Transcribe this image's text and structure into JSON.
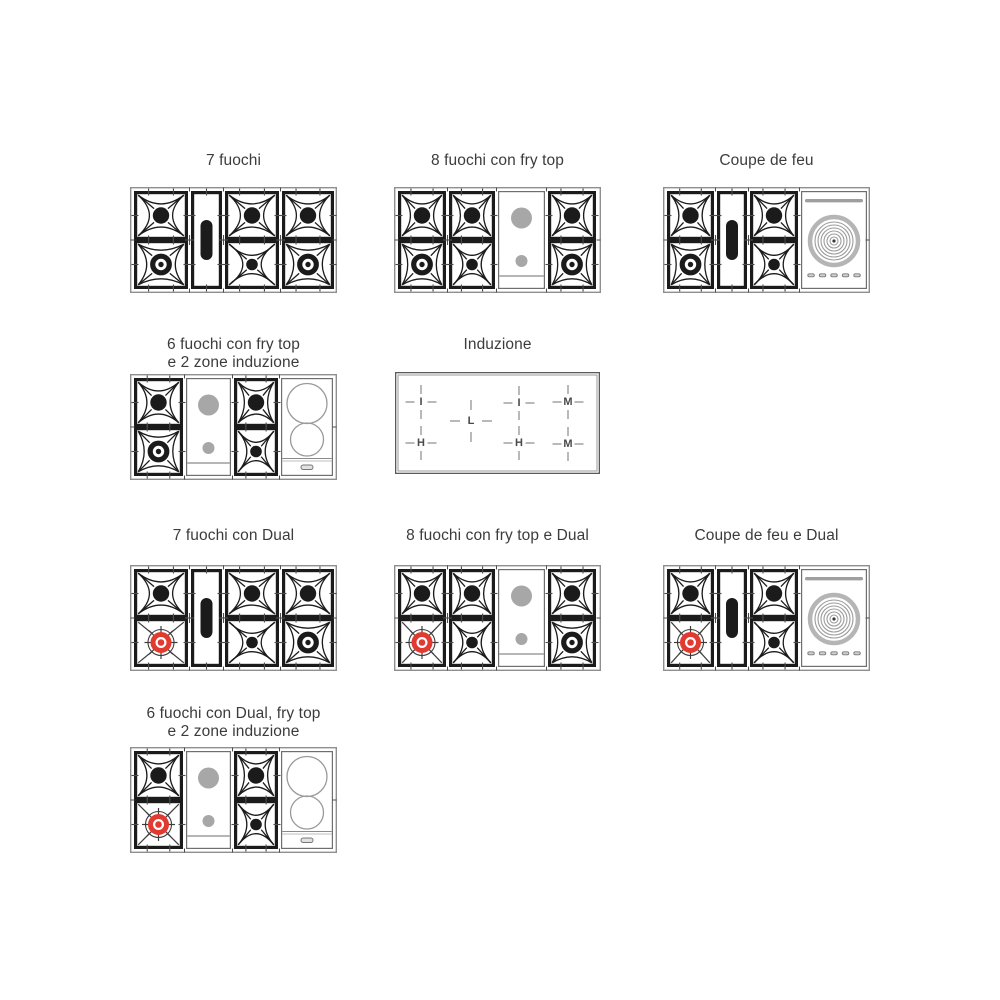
{
  "page": {
    "background": "#ffffff"
  },
  "colors": {
    "burner_black": "#1b1b1b",
    "dual_red": "#e03a31",
    "frytop_gray": "#a7a7a7",
    "panel_border": "#6f6f6f",
    "frame_gray": "#8f8f8f",
    "tick_gray": "#4d4d4d",
    "ring_light_gray": "#b5b5b5",
    "ring_mid_gray": "#9c9c9c",
    "title_text": "#3c3c3c",
    "induction_letter": "#4a4a4a",
    "induction_dash": "#8a8a8a"
  },
  "diagrams": [
    {
      "name": "7-fuochi",
      "title": "7 fuochi",
      "title_top": 152,
      "frame": {
        "x": 130,
        "y": 187,
        "w": 207,
        "h": 106
      },
      "sections": [
        {
          "type": "burners",
          "w": 54,
          "top": "large-burner",
          "bottom": "ring-burner"
        },
        {
          "type": "oval",
          "w": 31
        },
        {
          "type": "burners",
          "w": 54,
          "top": "large-burner",
          "bottom": "small-burner"
        },
        {
          "type": "burners",
          "w": 52,
          "top": "large-burner",
          "bottom": "ring-burner"
        }
      ]
    },
    {
      "name": "8-fuochi-con-fry-top",
      "title": "8 fuochi con fry top",
      "title_top": 152,
      "frame": {
        "x": 394,
        "y": 187,
        "w": 207,
        "h": 106
      },
      "sections": [
        {
          "type": "burners",
          "w": 48,
          "top": "large-burner",
          "bottom": "ring-burner"
        },
        {
          "type": "burners",
          "w": 46,
          "top": "large-burner",
          "bottom": "small-burner"
        },
        {
          "type": "fry-top",
          "w": 47
        },
        {
          "type": "burners",
          "w": 48,
          "top": "large-burner",
          "bottom": "ring-burner"
        }
      ]
    },
    {
      "name": "coupe-de-feu",
      "title": "Coupe de feu",
      "title_top": 152,
      "frame": {
        "x": 663,
        "y": 187,
        "w": 207,
        "h": 106
      },
      "sections": [
        {
          "type": "burners",
          "w": 47,
          "top": "large-burner",
          "bottom": "ring-burner"
        },
        {
          "type": "oval",
          "w": 30
        },
        {
          "type": "burners",
          "w": 48,
          "top": "large-burner",
          "bottom": "small-burner"
        },
        {
          "type": "coupe",
          "w": 66
        }
      ]
    },
    {
      "name": "6-fuochi-fry-top-induzione",
      "title": "6 fuochi con fry top\ne 2 zone induzione",
      "title_top": 336,
      "frame": {
        "x": 130,
        "y": 374,
        "w": 207,
        "h": 106
      },
      "sections": [
        {
          "type": "burners",
          "w": 49,
          "top": "large-burner",
          "bottom": "ring-burner"
        },
        {
          "type": "fry-top",
          "w": 45
        },
        {
          "type": "burners",
          "w": 44,
          "top": "large-burner",
          "bottom": "small-burner"
        },
        {
          "type": "induction-2",
          "w": 52
        }
      ]
    },
    {
      "name": "induzione",
      "title": "Induzione",
      "title_top": 336,
      "kind": "induction-cooktop",
      "frame": {
        "x": 395,
        "y": 372,
        "w": 205,
        "h": 102
      },
      "zones": [
        {
          "label": "I",
          "x": 26,
          "y": 30,
          "big": false
        },
        {
          "label": "L",
          "x": 76,
          "y": 49,
          "big": true
        },
        {
          "label": "I",
          "x": 124,
          "y": 31,
          "big": false
        },
        {
          "label": "M",
          "x": 173,
          "y": 30,
          "big": false
        },
        {
          "label": "H",
          "x": 26,
          "y": 71,
          "big": false
        },
        {
          "label": "H",
          "x": 124,
          "y": 71,
          "big": false
        },
        {
          "label": "M",
          "x": 173,
          "y": 72,
          "big": false
        }
      ]
    },
    {
      "name": "7-fuochi-con-dual",
      "title": "7 fuochi con Dual",
      "title_top": 527,
      "frame": {
        "x": 130,
        "y": 565,
        "w": 207,
        "h": 106
      },
      "sections": [
        {
          "type": "burners",
          "w": 54,
          "top": "large-burner",
          "bottom": "dual-burner"
        },
        {
          "type": "oval",
          "w": 31
        },
        {
          "type": "burners",
          "w": 54,
          "top": "large-burner",
          "bottom": "small-burner"
        },
        {
          "type": "burners",
          "w": 52,
          "top": "large-burner",
          "bottom": "ring-burner"
        }
      ]
    },
    {
      "name": "8-fuochi-fry-top-dual",
      "title": "8 fuochi con fry top e Dual",
      "title_top": 527,
      "frame": {
        "x": 394,
        "y": 565,
        "w": 207,
        "h": 106
      },
      "sections": [
        {
          "type": "burners",
          "w": 48,
          "top": "large-burner",
          "bottom": "dual-burner"
        },
        {
          "type": "burners",
          "w": 46,
          "top": "large-burner",
          "bottom": "small-burner"
        },
        {
          "type": "fry-top",
          "w": 47
        },
        {
          "type": "burners",
          "w": 48,
          "top": "large-burner",
          "bottom": "ring-burner"
        }
      ]
    },
    {
      "name": "coupe-de-feu-e-dual",
      "title": "Coupe de feu e Dual",
      "title_top": 527,
      "frame": {
        "x": 663,
        "y": 565,
        "w": 207,
        "h": 106
      },
      "sections": [
        {
          "type": "burners",
          "w": 47,
          "top": "large-burner",
          "bottom": "dual-burner"
        },
        {
          "type": "oval",
          "w": 30
        },
        {
          "type": "burners",
          "w": 48,
          "top": "large-burner",
          "bottom": "small-burner"
        },
        {
          "type": "coupe",
          "w": 66
        }
      ]
    },
    {
      "name": "6-fuochi-dual-fry-top-induzione",
      "title": "6 fuochi con Dual, fry top\ne 2 zone induzione",
      "title_top": 705,
      "frame": {
        "x": 130,
        "y": 747,
        "w": 207,
        "h": 106
      },
      "sections": [
        {
          "type": "burners",
          "w": 49,
          "top": "large-burner",
          "bottom": "dual-burner"
        },
        {
          "type": "fry-top",
          "w": 45
        },
        {
          "type": "burners",
          "w": 44,
          "top": "large-burner",
          "bottom": "small-burner"
        },
        {
          "type": "induction-2",
          "w": 52
        }
      ]
    }
  ]
}
